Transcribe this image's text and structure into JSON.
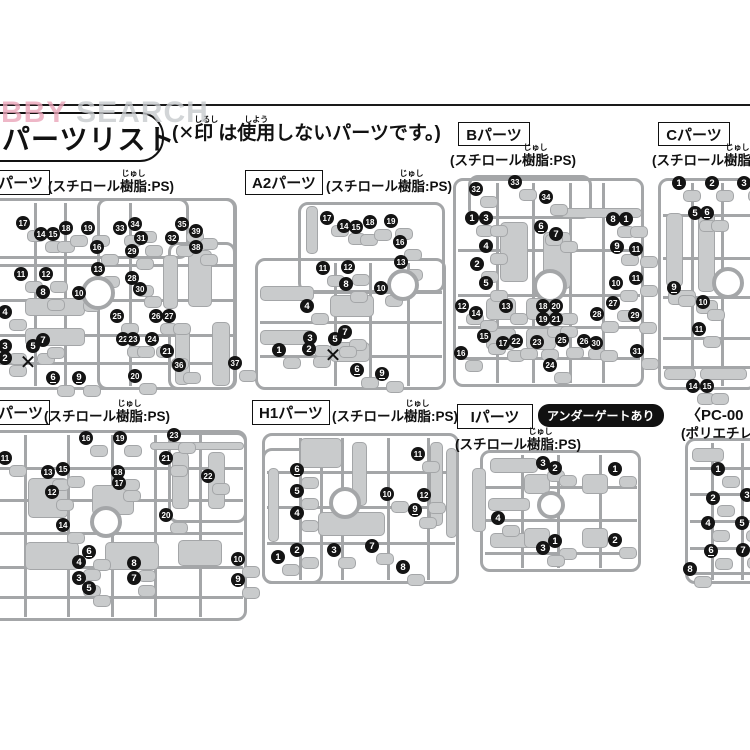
{
  "colors": {
    "runner": "#a4a6a8",
    "part": "#c9cbcc",
    "badge": "#141414",
    "watermark_pink": "#eba6ba",
    "watermark_gray": "#c8cbce"
  },
  "glyphs": {
    "cross": "✕"
  },
  "header": {
    "watermark": {
      "pink": "HOBBY",
      "gray": " SEARCH"
    },
    "title": "パーツリスト",
    "note": [
      {
        "t": "(✕"
      },
      {
        "t": "印",
        "rt": "しるし"
      },
      {
        "t": "は"
      },
      {
        "t": "使用",
        "rt": "しよう"
      },
      {
        "t": "しないパーツです。)"
      }
    ]
  },
  "materials": {
    "ps": [
      {
        "t": "(スチロール"
      },
      {
        "t": "樹脂",
        "rt": "じゅし"
      },
      {
        "t": ":PS)"
      }
    ]
  },
  "sprues": [
    {
      "id": "a1",
      "label": "パーツ",
      "label_box": [
        -50,
        170,
        92,
        23
      ],
      "label_cut": true,
      "material": "ps",
      "material_pos": [
        48,
        170
      ],
      "outer": [
        -20,
        198,
        258,
        193
      ],
      "frames": [
        [
          -20,
          198,
          210,
          62
        ],
        [
          97,
          198,
          140,
          193
        ],
        [
          168,
          242,
          69,
          149
        ]
      ],
      "vlines": [
        35,
        65,
        130
      ],
      "hlines": [
        265,
        300,
        335,
        363
      ],
      "hub": [
        98,
        293,
        13
      ],
      "blobs": [
        [
          188,
          250,
          22,
          55
        ],
        [
          175,
          325,
          13,
          58
        ],
        [
          212,
          322,
          16,
          62
        ],
        [
          163,
          255,
          13,
          52
        ],
        [
          25,
          298,
          58,
          16
        ],
        [
          25,
          328,
          58,
          16
        ]
      ],
      "crosses": [
        [
          28,
          363
        ]
      ],
      "badges": [
        [
          17,
          23,
          223
        ],
        [
          14,
          41,
          234
        ],
        [
          15,
          53,
          234
        ],
        [
          18,
          66,
          228
        ],
        [
          19,
          88,
          228
        ],
        [
          33,
          120,
          228
        ],
        [
          34,
          135,
          224
        ],
        [
          35,
          182,
          224
        ],
        [
          39,
          196,
          231
        ],
        [
          38,
          196,
          247
        ],
        [
          31,
          141,
          238
        ],
        [
          32,
          172,
          238
        ],
        [
          29,
          132,
          251
        ],
        [
          16,
          97,
          247
        ],
        [
          13,
          98,
          269
        ],
        [
          28,
          132,
          278
        ],
        [
          30,
          140,
          289
        ],
        [
          11,
          21,
          274
        ],
        [
          12,
          46,
          274
        ],
        [
          8,
          43,
          292
        ],
        [
          10,
          79,
          293
        ],
        [
          4,
          5,
          312
        ],
        [
          25,
          117,
          316
        ],
        [
          26,
          156,
          316
        ],
        [
          27,
          169,
          316
        ],
        [
          3,
          5,
          346
        ],
        [
          2,
          5,
          358
        ],
        [
          5,
          33,
          346
        ],
        [
          7,
          43,
          340
        ],
        [
          6,
          53,
          378
        ],
        [
          9,
          79,
          378
        ],
        [
          22,
          123,
          339
        ],
        [
          23,
          133,
          339
        ],
        [
          24,
          152,
          339
        ],
        [
          21,
          167,
          351
        ],
        [
          20,
          135,
          376
        ],
        [
          36,
          179,
          365
        ],
        [
          37,
          235,
          363
        ]
      ]
    },
    {
      "id": "a2",
      "label": "A2パーツ",
      "label_box": [
        245,
        170,
        76,
        23
      ],
      "material": "ps",
      "material_pos": [
        326,
        170
      ],
      "outer": [
        255,
        258,
        192,
        133
      ],
      "frames": [
        [
          298,
          202,
          148,
          92
        ]
      ],
      "vlines": [
        335,
        370,
        408
      ],
      "hlines": [
        292,
        322,
        356
      ],
      "hub": [
        403,
        285,
        12
      ],
      "blobs": [
        [
          260,
          286,
          52,
          13
        ],
        [
          260,
          330,
          52,
          13
        ],
        [
          306,
          206,
          10,
          46
        ],
        [
          330,
          295,
          42,
          20
        ],
        [
          330,
          342,
          38,
          18
        ]
      ],
      "crosses": [
        [
          333,
          356
        ]
      ],
      "badges": [
        [
          17,
          327,
          218
        ],
        [
          14,
          344,
          226
        ],
        [
          15,
          356,
          227
        ],
        [
          18,
          370,
          222
        ],
        [
          19,
          391,
          221
        ],
        [
          16,
          400,
          242
        ],
        [
          11,
          323,
          268
        ],
        [
          12,
          348,
          267
        ],
        [
          13,
          401,
          262
        ],
        [
          8,
          346,
          284
        ],
        [
          10,
          381,
          288
        ],
        [
          4,
          307,
          306
        ],
        [
          3,
          310,
          338
        ],
        [
          7,
          345,
          332
        ],
        [
          5,
          335,
          339
        ],
        [
          1,
          279,
          350
        ],
        [
          2,
          309,
          349
        ],
        [
          6,
          357,
          370
        ],
        [
          9,
          382,
          374
        ]
      ]
    },
    {
      "id": "b",
      "label": "Bパーツ",
      "label_box": [
        458,
        122,
        70,
        22
      ],
      "material": "ps",
      "material_pos": [
        450,
        144
      ],
      "outer": [
        453,
        178,
        192,
        210
      ],
      "frames": [
        [
          468,
          175,
          125,
          45
        ]
      ],
      "vlines": [
        497,
        533,
        570,
        603
      ],
      "hlines": [
        250,
        295,
        327,
        358
      ],
      "hub": [
        550,
        286,
        13
      ],
      "blobs": [
        [
          500,
          222,
          26,
          58
        ],
        [
          543,
          232,
          26,
          55
        ],
        [
          486,
          298,
          28,
          20
        ],
        [
          526,
          298,
          28,
          20
        ],
        [
          486,
          328,
          28,
          20
        ],
        [
          526,
          328,
          28,
          20
        ],
        [
          560,
          208,
          80,
          8
        ]
      ],
      "crosses": [],
      "badges": [
        [
          32,
          476,
          189
        ],
        [
          33,
          515,
          182
        ],
        [
          34,
          546,
          197
        ],
        [
          1,
          472,
          218
        ],
        [
          3,
          486,
          218
        ],
        [
          6,
          541,
          227
        ],
        [
          7,
          556,
          234
        ],
        [
          8,
          613,
          219
        ],
        [
          1,
          626,
          219
        ],
        [
          4,
          486,
          246
        ],
        [
          9,
          617,
          247
        ],
        [
          11,
          636,
          249
        ],
        [
          2,
          477,
          264
        ],
        [
          5,
          486,
          283
        ],
        [
          10,
          616,
          283
        ],
        [
          11,
          636,
          278
        ],
        [
          12,
          462,
          306
        ],
        [
          13,
          506,
          306
        ],
        [
          18,
          543,
          306
        ],
        [
          20,
          556,
          306
        ],
        [
          27,
          613,
          303
        ],
        [
          14,
          476,
          313
        ],
        [
          19,
          543,
          319
        ],
        [
          21,
          556,
          319
        ],
        [
          28,
          597,
          314
        ],
        [
          29,
          635,
          315
        ],
        [
          15,
          484,
          336
        ],
        [
          17,
          503,
          343
        ],
        [
          22,
          516,
          341
        ],
        [
          23,
          537,
          342
        ],
        [
          25,
          562,
          340
        ],
        [
          26,
          584,
          341
        ],
        [
          30,
          596,
          343
        ],
        [
          16,
          461,
          353
        ],
        [
          24,
          550,
          365
        ],
        [
          31,
          637,
          351
        ]
      ]
    },
    {
      "id": "c",
      "label": "Cパーツ",
      "label_box": [
        658,
        122,
        70,
        22
      ],
      "material": "ps",
      "material_pos": [
        652,
        144
      ],
      "outer": [
        658,
        178,
        100,
        213
      ],
      "frames": [],
      "vlines": [
        692,
        722
      ],
      "hlines": [
        215,
        258,
        297,
        338,
        367
      ],
      "hub": [
        728,
        283,
        12
      ],
      "blobs": [
        [
          666,
          213,
          15,
          72
        ],
        [
          698,
          212,
          15,
          78
        ],
        [
          668,
          290,
          26,
          13
        ],
        [
          696,
          300,
          20,
          12
        ],
        [
          664,
          368,
          30,
          10
        ],
        [
          700,
          368,
          45,
          10
        ]
      ],
      "crosses": [],
      "badges": [
        [
          1,
          679,
          183
        ],
        [
          2,
          712,
          183
        ],
        [
          3,
          744,
          183
        ],
        [
          5,
          695,
          213
        ],
        [
          6,
          707,
          213
        ],
        [
          9,
          674,
          288
        ],
        [
          10,
          703,
          302
        ],
        [
          11,
          699,
          329
        ],
        [
          14,
          693,
          386
        ],
        [
          15,
          707,
          386
        ]
      ]
    },
    {
      "id": "g",
      "label": "パーツ",
      "label_box": [
        -52,
        400,
        94,
        23
      ],
      "label_cut": true,
      "material": "ps",
      "material_pos": [
        44,
        400
      ],
      "outer": [
        -20,
        430,
        268,
        192
      ],
      "frames": [
        [
          168,
          432,
          80,
          92
        ]
      ],
      "vlines": [
        25,
        68,
        112,
        155,
        200
      ],
      "hlines": [
        468,
        500,
        533,
        567,
        597
      ],
      "hub": [
        106,
        522,
        12
      ],
      "blobs": [
        [
          172,
          452,
          15,
          55
        ],
        [
          208,
          452,
          15,
          55
        ],
        [
          150,
          442,
          92,
          6
        ],
        [
          28,
          478,
          38,
          38
        ],
        [
          92,
          485,
          40,
          28
        ],
        [
          25,
          542,
          52,
          26
        ],
        [
          105,
          542,
          52,
          26
        ],
        [
          178,
          540,
          42,
          24
        ]
      ],
      "crosses": [],
      "badges": [
        [
          11,
          5,
          458
        ],
        [
          16,
          86,
          438
        ],
        [
          19,
          120,
          438
        ],
        [
          23,
          174,
          435
        ],
        [
          21,
          166,
          458
        ],
        [
          13,
          48,
          472
        ],
        [
          15,
          63,
          469
        ],
        [
          18,
          118,
          472
        ],
        [
          22,
          208,
          476
        ],
        [
          12,
          52,
          492
        ],
        [
          17,
          119,
          483
        ],
        [
          14,
          63,
          525
        ],
        [
          20,
          166,
          515
        ],
        [
          6,
          89,
          552
        ],
        [
          4,
          79,
          562
        ],
        [
          8,
          134,
          563
        ],
        [
          10,
          238,
          559
        ],
        [
          3,
          79,
          578
        ],
        [
          7,
          134,
          578
        ],
        [
          9,
          238,
          580
        ],
        [
          5,
          89,
          588
        ]
      ]
    },
    {
      "id": "h1",
      "label": "H1パーツ",
      "label_box": [
        252,
        400,
        76,
        23
      ],
      "material": "ps",
      "material_pos": [
        332,
        400
      ],
      "outer": [
        262,
        433,
        198,
        152
      ],
      "frames": [
        [
          262,
          448,
          62,
          137
        ]
      ],
      "vlines": [
        300,
        342,
        388,
        428
      ],
      "hlines": [
        472,
        507,
        543
      ],
      "hub": [
        345,
        503,
        12
      ],
      "blobs": [
        [
          268,
          468,
          9,
          72
        ],
        [
          352,
          442,
          13,
          62
        ],
        [
          430,
          442,
          11,
          82
        ],
        [
          446,
          448,
          9,
          88
        ],
        [
          318,
          512,
          65,
          22
        ],
        [
          300,
          438,
          40,
          28
        ]
      ],
      "crosses": [],
      "badges": [
        [
          11,
          418,
          454
        ],
        [
          6,
          297,
          470
        ],
        [
          5,
          297,
          491
        ],
        [
          10,
          387,
          494
        ],
        [
          12,
          424,
          495
        ],
        [
          9,
          415,
          510
        ],
        [
          4,
          297,
          513
        ],
        [
          7,
          372,
          546
        ],
        [
          2,
          297,
          550
        ],
        [
          3,
          334,
          550
        ],
        [
          1,
          278,
          557
        ],
        [
          8,
          403,
          567
        ]
      ]
    },
    {
      "id": "i",
      "label": "Iパーツ",
      "label_box": [
        457,
        404,
        74,
        23
      ],
      "gate": "アンダーゲートあり",
      "gate_pos": [
        538,
        404
      ],
      "material": "ps",
      "material_pos": [
        455,
        428
      ],
      "outer": [
        480,
        450,
        162,
        123
      ],
      "frames": [],
      "vlines": [
        522,
        558,
        600
      ],
      "hlines": [
        487,
        520,
        553
      ],
      "hub": [
        551,
        505,
        10
      ],
      "blobs": [
        [
          490,
          458,
          46,
          13
        ],
        [
          488,
          498,
          40,
          11
        ],
        [
          490,
          533,
          46,
          13
        ],
        [
          524,
          474,
          24,
          18
        ],
        [
          582,
          474,
          24,
          18
        ],
        [
          524,
          528,
          24,
          18
        ],
        [
          582,
          528,
          24,
          18
        ],
        [
          472,
          468,
          12,
          62
        ]
      ],
      "crosses": [],
      "badges": [
        [
          3,
          543,
          463
        ],
        [
          2,
          555,
          468
        ],
        [
          1,
          615,
          469
        ],
        [
          4,
          498,
          518
        ],
        [
          1,
          555,
          541
        ],
        [
          3,
          543,
          548
        ],
        [
          2,
          615,
          540
        ]
      ]
    },
    {
      "id": "pc",
      "label_lines": [
        {
          "t": "〈PC-00",
          "x": 686,
          "y": 404,
          "s": 15
        },
        {
          "t": "(ポリエチレン",
          "x": 681,
          "y": 422,
          "s": 13.5
        }
      ],
      "outer": [
        685,
        438,
        80,
        147
      ],
      "frames": [],
      "vlines": [
        712,
        742
      ],
      "hlines": [
        468,
        494,
        521,
        548,
        573
      ],
      "blobs": [
        [
          692,
          448,
          30,
          12
        ]
      ],
      "crosses": [],
      "badges": [
        [
          1,
          718,
          469
        ],
        [
          2,
          713,
          498
        ],
        [
          3,
          747,
          495
        ],
        [
          4,
          708,
          523
        ],
        [
          5,
          742,
          523
        ],
        [
          6,
          711,
          551
        ],
        [
          7,
          743,
          550
        ],
        [
          8,
          690,
          569
        ]
      ]
    }
  ]
}
